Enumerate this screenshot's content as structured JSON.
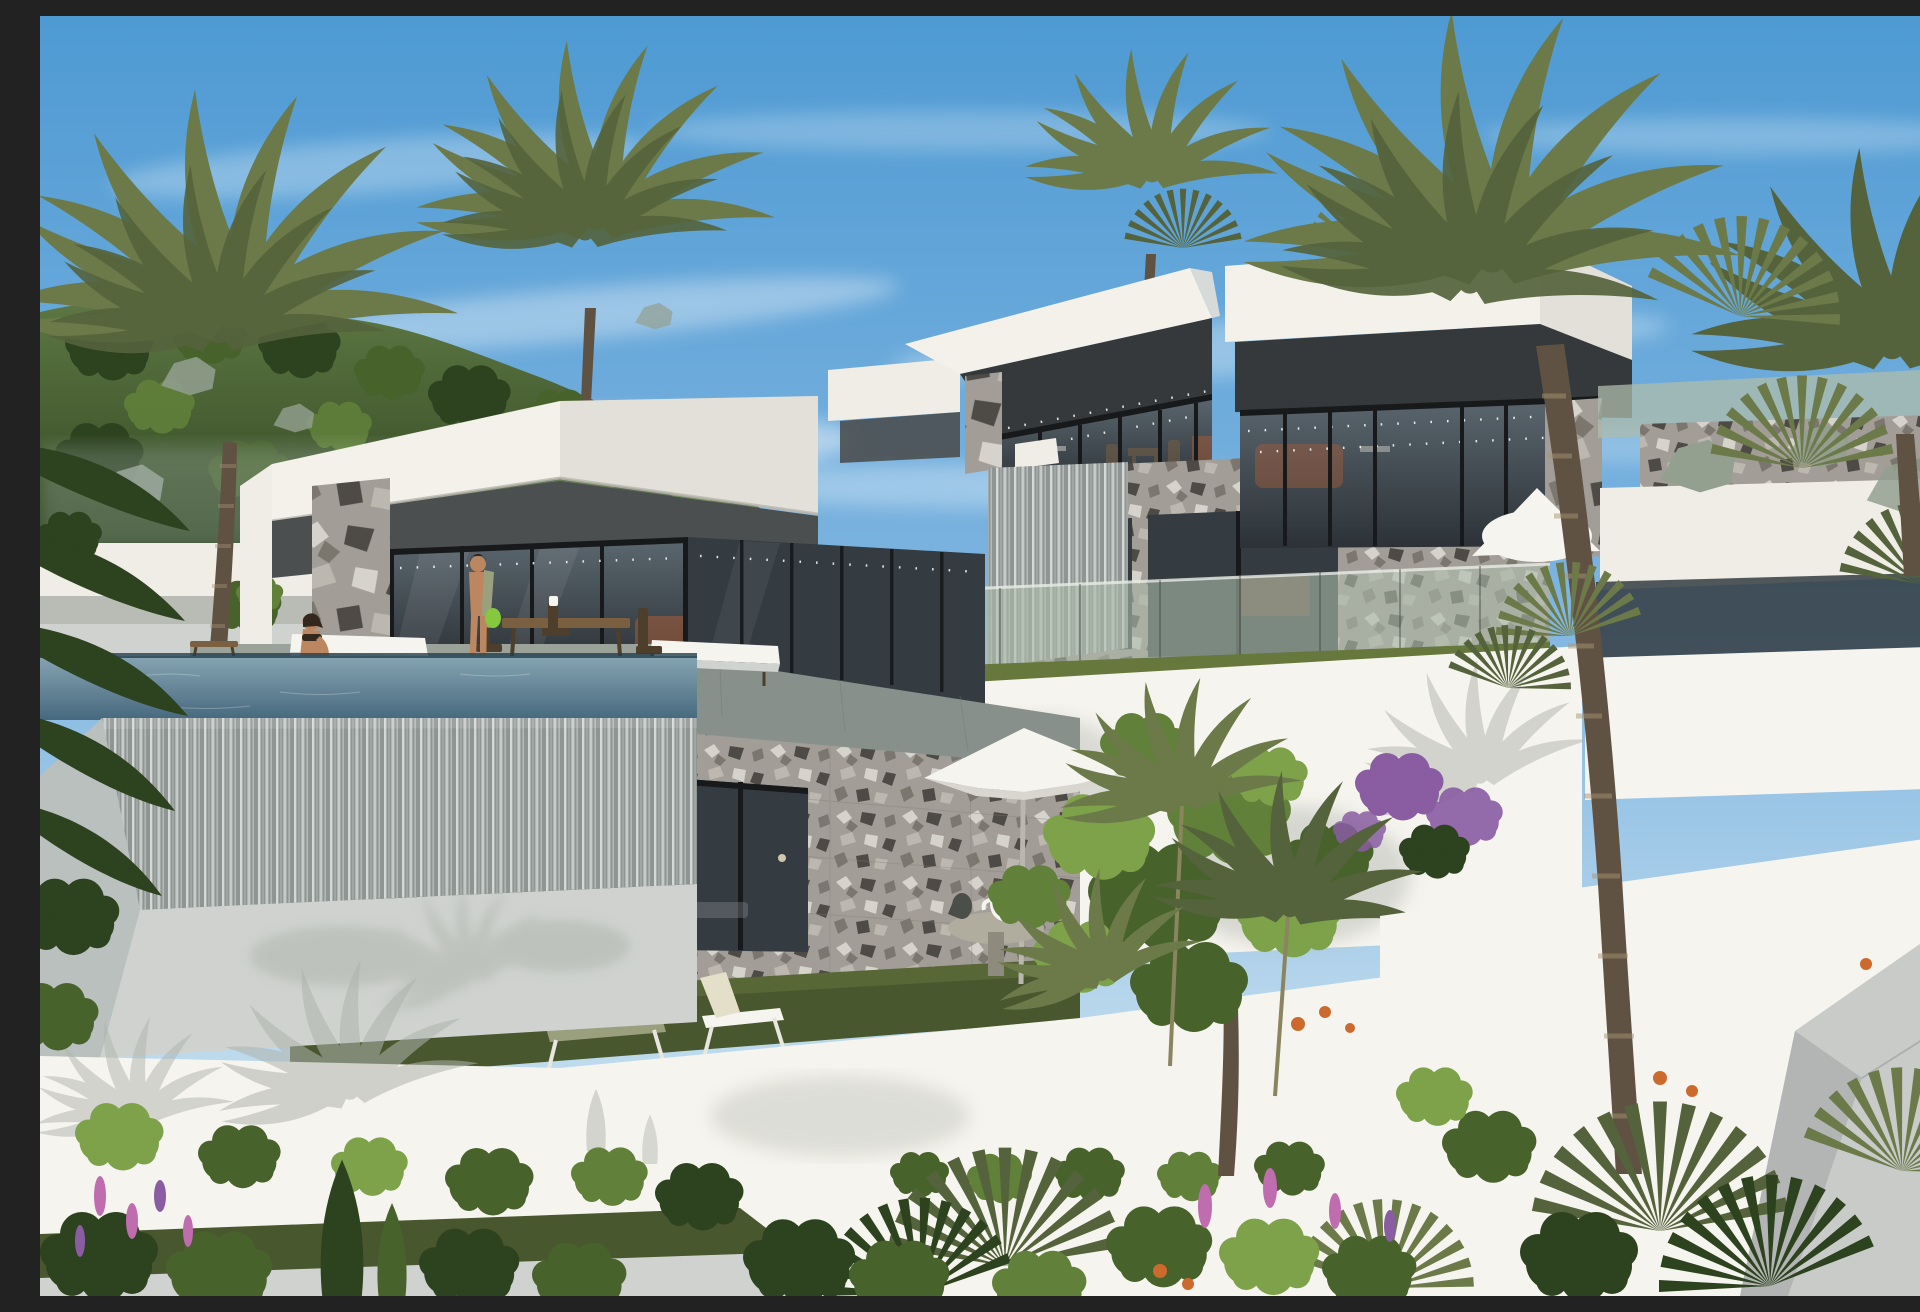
{
  "meta": {
    "description": "Photorealistic render of three modern white flat-roof villas stepped down a sunny hillside, with terrazzo stone cladding, dark glass walls, an infinity pool with water-curtain edge, white terraced retaining walls and dense Mediterranean tropical planting under a blue sky"
  },
  "palette": {
    "sky-top": "#4e9ad3",
    "sky-mid": "#7db4e0",
    "sky-low": "#b8d7ec",
    "sky-horizon": "#d9e9f3",
    "cloud": "#f4f8fb",
    "hill-top": "#5d7743",
    "hill-bottom": "#2f441f",
    "rock": "#93a090",
    "wall-white": "#efede6",
    "wall-bright": "#f6f4ee",
    "wall-shade": "#cfd2cf",
    "roof-white": "#f3f1ea",
    "roof-side": "#e2e0d8",
    "band-dark": "#4b4f50",
    "band-deep": "#36393b",
    "glass-dark": "#343c41",
    "glass-top": "#5a666e",
    "glass-bottom": "#2c3237",
    "frame-black": "#17191b",
    "stone-base": "#a29d96",
    "stone-chip-light": "#d6d3cc",
    "stone-chip-mid": "#7b776f",
    "stone-chip-dark": "#4e4b46",
    "stone-chip-warm": "#bcb8b0",
    "fall-base": "#8e9592",
    "fall-streak": "#e6e9e7",
    "terrace": "#87908a",
    "terrace-light": "#9aa29a",
    "water-near": "#86a4b2",
    "water-far": "#47697e",
    "grass": "#49572f",
    "grass-light": "#66783c",
    "bush-dark": "#2d421e",
    "bush-mid": "#48622c",
    "bush-light": "#61803a",
    "bush-bright": "#7da24a",
    "palm-olive": "#6c7a4a",
    "palm-olive-dark": "#55633c",
    "trunk": "#8d7a5f",
    "trunk-dark": "#5f5242",
    "sage-glass": "#aebcab",
    "bougainvillea": "#8a5da2",
    "flower-pink": "#c06db0",
    "flower-orange": "#cc6a2e",
    "sofa-rust": "#a85c38",
    "wood": "#7b5f41",
    "wood-dark": "#4e3e2c",
    "skin": "#bb8660",
    "hair": "#33271e",
    "towel": "#9aa07e",
    "bag-green": "#84c83e",
    "umbrella": "#f5f4ef",
    "ramp-grey": "#c9cbc9",
    "ramp-grey-dark": "#b2b5b3",
    "ivy-green": "#3f5c28",
    "shadow-tint": "#aeb3ab"
  },
  "scene": {
    "setting": {
      "time": "bright midday",
      "sky": "clear blue with thin cirrus wisps",
      "location": "pine-forested hillside, upper left background"
    },
    "villas": [
      {
        "id": "left-villa",
        "roof": "thick white cantilevered flat roof slab",
        "upper_band": "dark grey recessed soffit band",
        "facade": [
          "floor-to-ceiling dark glazing with black mullions",
          "full-height grey terrazzo stone pier",
          "terrazzo stone basement wall with three dark openings"
        ],
        "terrace": {
          "floor": "grey stone deck",
          "furniture": [
            "two white-cushioned sun loungers",
            "wooden side table",
            "wooden dining table with four chairs",
            "two small pendant lamps"
          ],
          "interior_hint": "rust-orange sofa behind corner glazing"
        },
        "garden": {
          "lawn": "green lawn strip below basement",
          "furniture": [
            "olive sling lounger",
            "cream reclined lounger"
          ]
        }
      },
      {
        "id": "middle-villa",
        "roof": "white flat roof slab with rooftop palm tufts",
        "upper_band": "dark grey fascia",
        "facade": [
          "glass wall with string lights",
          "terrazzo stone pier",
          "white water-spout box with falling water curtain",
          "terrazzo lower wall with two dark windows",
          "sage-tinted glass balustrade"
        ],
        "interior_hint": "wooden dining chairs and table",
        "base": "tall bright white retaining wall with purple bougainvillea"
      },
      {
        "id": "right-villa",
        "roof": "white flat roof slab",
        "upper_band": "dark grey fascia",
        "facade": [
          "glass wall with string lights",
          "terrazzo stone corner pier",
          "sage glass balustrade strips",
          "stone and white terrace walls at right"
        ],
        "interior_hint": "rust-orange sofa behind glass"
      }
    ],
    "pool": {
      "type": "infinity pool",
      "edge": "water-curtain cascade over terrazzo lip",
      "water": "blue-grey reflective"
    },
    "people": [
      {
        "id": "woman-at-pool",
        "pose": "sitting at pool edge with legs in water",
        "outfit": "black bikini, dark hair"
      },
      {
        "id": "man-on-terrace",
        "pose": "standing by dining table",
        "accessories": [
          "olive towel over shoulder",
          "green beach bag"
        ]
      }
    ],
    "amenities": {
      "umbrella": "white parasol on central lawn",
      "side_table": "round grey garden table with white kettle and dark planter",
      "loungers_total": 4
    },
    "landscape": {
      "terracing": "stepped white rendered retaining walls with lawn strips",
      "vines": "ivy curtains hanging over wall edges",
      "trees": [
        "tall date palms left, centre and right",
        "fan palms right and foreground",
        "bright green ficus tree centre-right",
        "slim cypress bottom left"
      ],
      "flowers": [
        "purple bougainvillea",
        "pink flower spikes",
        "orange accents"
      ],
      "hardscape_right": "light grey angled access-ramp walls, bottom right corner"
    }
  }
}
